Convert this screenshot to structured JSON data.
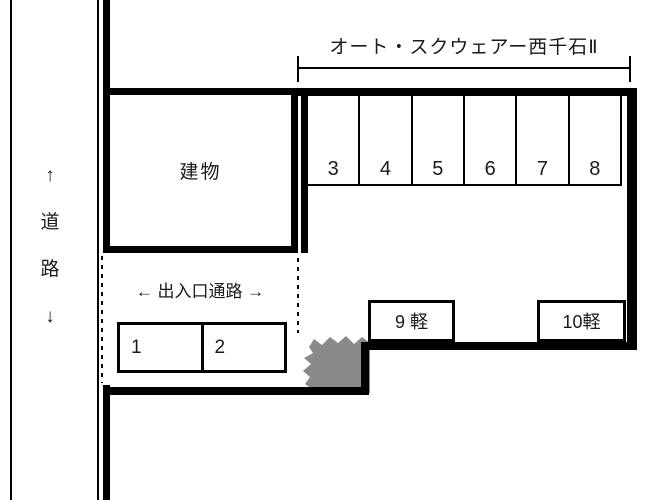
{
  "title": "オート・スクウェアー西千石Ⅱ",
  "road": {
    "chars": [
      "↑",
      "道",
      "路",
      "↓"
    ]
  },
  "building": {
    "label": "建物"
  },
  "passage": {
    "label": "← 出入口通路 →"
  },
  "spaces": {
    "row_top": [
      "3",
      "4",
      "5",
      "6",
      "7",
      "8"
    ],
    "kei": [
      "9 軽",
      "10軽"
    ],
    "row_bottom": [
      "1",
      "2"
    ]
  },
  "colors": {
    "line": "#000000",
    "bush": "#8a8a8a",
    "text": "#1a1a1a"
  }
}
